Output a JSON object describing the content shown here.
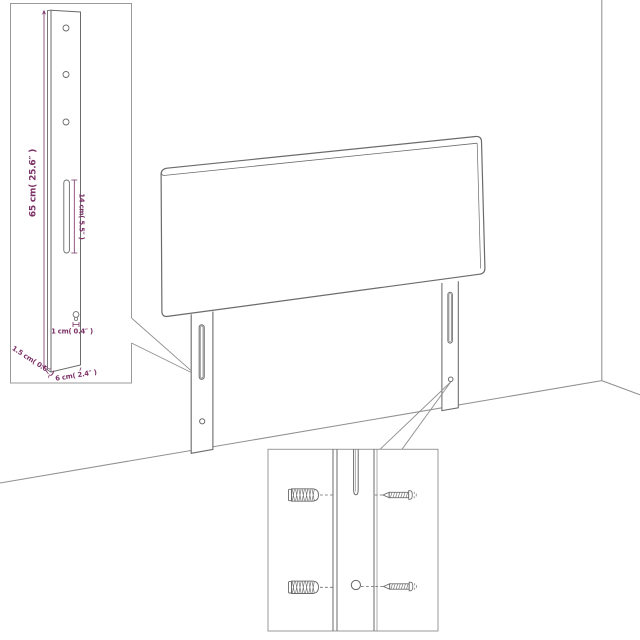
{
  "figure": {
    "background": "#ffffff",
    "line_color": "#6b6b6b",
    "soft_line_color": "#909090",
    "inset_border_color": "#9a9a9a",
    "dimension_color": "#7b3066",
    "panel_fill": "#ffffff"
  },
  "insets": {
    "leg_dimensions": {
      "labels": {
        "height": "65 cm( 25.6″ )",
        "slot_height": "14 cm( 5.5″ )",
        "hole": "1 cm( 0.4″ )",
        "thickness": "1.5 cm( 0.6″ )",
        "width": "6 cm( 2.4″ )"
      }
    }
  }
}
